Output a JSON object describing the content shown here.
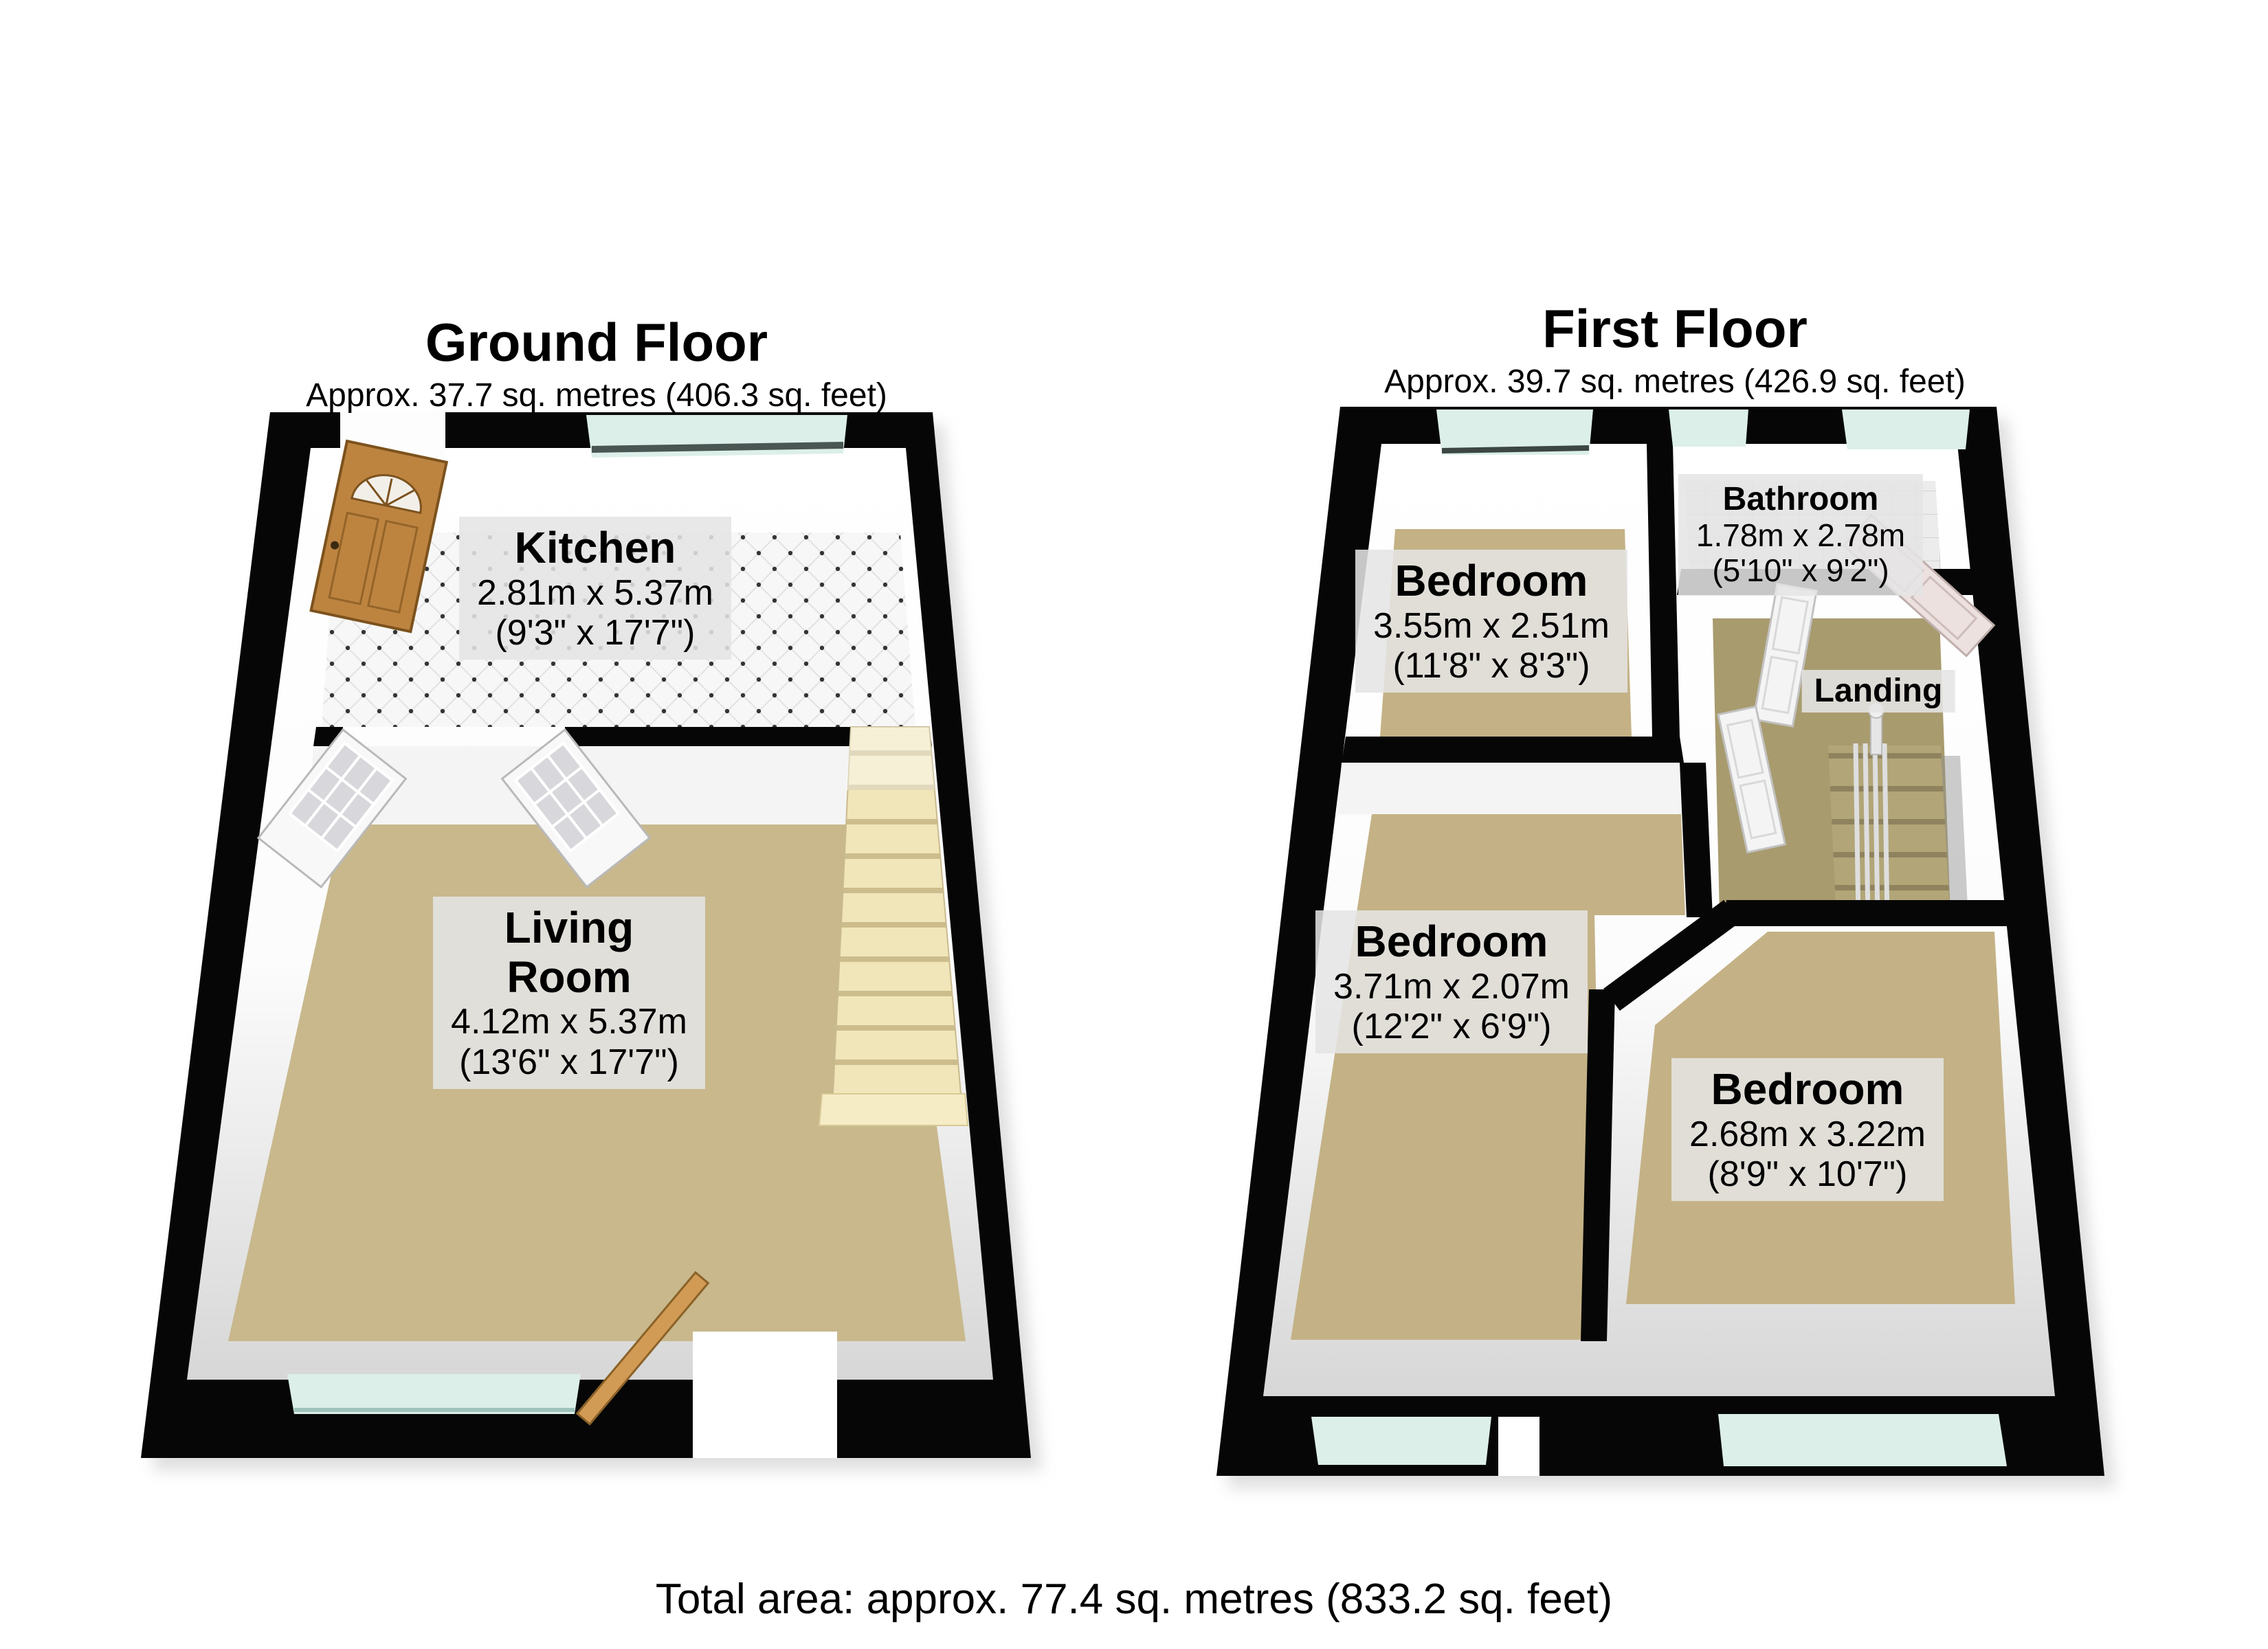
{
  "ground_floor": {
    "title": "Ground Floor",
    "subtitle": "Approx. 37.7 sq. metres (406.3 sq. feet)",
    "rooms": [
      {
        "name": "Kitchen",
        "dims_metric": "2.81m x 5.37m",
        "dims_imperial": "(9'3\" x 17'7\")"
      },
      {
        "name": "Living\nRoom",
        "dims_metric": "4.12m x 5.37m",
        "dims_imperial": "(13'6\" x 17'7\")"
      }
    ]
  },
  "first_floor": {
    "title": "First Floor",
    "subtitle": "Approx. 39.7 sq. metres (426.9 sq. feet)",
    "rooms": [
      {
        "name": "Bedroom",
        "dims_metric": "3.55m x 2.51m",
        "dims_imperial": "(11'8\" x 8'3\")"
      },
      {
        "name": "Bathroom",
        "dims_metric": "1.78m x 2.78m",
        "dims_imperial": "(5'10\" x 9'2\")"
      },
      {
        "name": "Landing"
      },
      {
        "name": "Bedroom",
        "dims_metric": "3.71m x 2.07m",
        "dims_imperial": "(12'2\" x 6'9\")"
      },
      {
        "name": "Bedroom",
        "dims_metric": "2.68m x 3.22m",
        "dims_imperial": "(8'9\" x 10'7\")"
      }
    ]
  },
  "footer": {
    "total_area": "Total area: approx. 77.4 sq. metres (833.2 sq. feet)"
  },
  "colors": {
    "wall": "#060606",
    "wall_face": "#f2f2f2",
    "carpet_ground": "#c8b88c",
    "carpet_bedroom": "#c4b286",
    "carpet_landing": "#a89b6e",
    "window_glass": "#dcefe9",
    "kitchen_tile": "#f7f7f7",
    "bathroom_tile": "#ececec",
    "stairs_ground": "#f0e6ba",
    "stairs_first": "#b2a577",
    "wood_door": "#bd8440",
    "label_background": "#e5e5e5"
  }
}
